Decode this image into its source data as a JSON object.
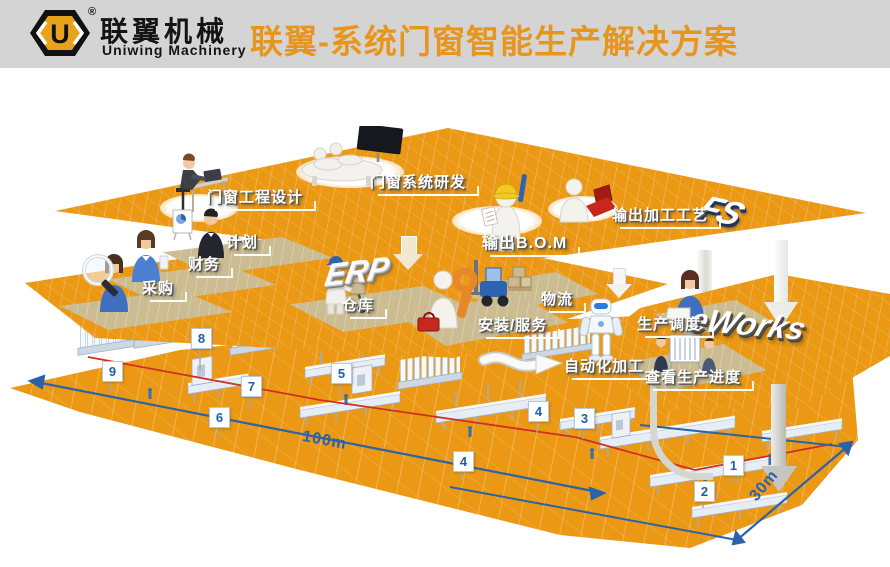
{
  "header": {
    "logo_text": "U",
    "reg": "®",
    "brand_cn": "联翼机械",
    "brand_en": "Uniwing Machinery",
    "title": "联翼-系统门窗智能生产解决方案"
  },
  "layers": {
    "design": {
      "badge": "FS",
      "stations": [
        {
          "label": "门窗工程设计"
        },
        {
          "label": "门窗系统研发"
        },
        {
          "label": "输出B.O.M"
        },
        {
          "label": "输出加工工艺"
        }
      ]
    },
    "erp": {
      "badge": "ERP",
      "stations": [
        {
          "label": "计划"
        },
        {
          "label": "财务"
        },
        {
          "label": "采购"
        },
        {
          "label": "仓库"
        },
        {
          "label": "物流"
        },
        {
          "label": "安装/服务"
        }
      ]
    },
    "eworks": {
      "badge": "eWorks",
      "stations": [
        {
          "label": "生产调度"
        },
        {
          "label": "自动化加工"
        },
        {
          "label": "查看生产进度"
        }
      ]
    },
    "floor": {
      "markers": [
        "9",
        "8",
        "7",
        "6",
        "5",
        "4",
        "4",
        "3",
        "2",
        "1"
      ],
      "dimensions": {
        "length": "100m",
        "width": "30m"
      }
    }
  },
  "colors": {
    "platform_orange": "#EB9914",
    "title_orange": "#E8951C",
    "dim_blue": "#2B62A8",
    "line_red": "#D03020",
    "logo_yellow": "#E8A21C"
  }
}
